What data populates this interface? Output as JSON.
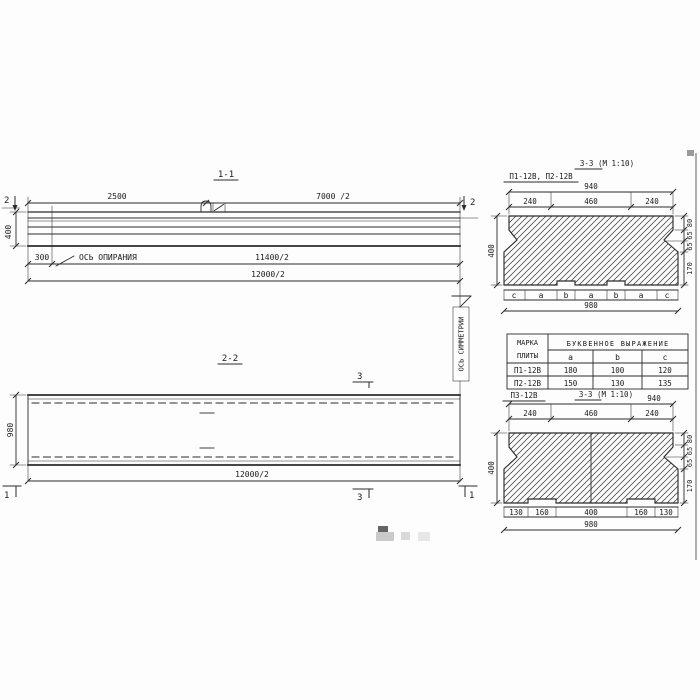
{
  "s11": {
    "title": "1-1",
    "d2500": "2500",
    "d7000": "7000 /2",
    "mark2": "2",
    "d400": "400",
    "d300": "300",
    "support_axis": "ОСЬ ОПИРАНИЯ",
    "d11400": "11400/2",
    "d12000": "12000/2"
  },
  "s22": {
    "title": "2-2",
    "mark3": "3",
    "mark1": "1",
    "d980": "980",
    "d12000": "12000/2"
  },
  "sym": {
    "label": "ОСЬ СИММЕТРИИ"
  },
  "s33t": {
    "title": "3-3 (М 1:10)",
    "marks": "П1-12В, П2-12В",
    "d940": "940",
    "top": [
      "240",
      "460",
      "240"
    ],
    "d400": "400",
    "h": [
      "80",
      "65",
      "65",
      "170"
    ],
    "letters": [
      "c",
      "a",
      "b",
      "a",
      "b",
      "a",
      "c"
    ],
    "d980": "980"
  },
  "tbl": {
    "h1a": "МАРКА",
    "h1b": "ПЛИТЫ",
    "h2": "БУКВЕННОЕ ВЫРАЖЕНИЕ",
    "sub": [
      "a",
      "b",
      "c"
    ],
    "rows": [
      {
        "mark": "П1-12В",
        "a": "180",
        "b": "100",
        "c": "120"
      },
      {
        "mark": "П2-12В",
        "a": "150",
        "b": "130",
        "c": "135"
      }
    ]
  },
  "s33b": {
    "title": "3-3 (М 1:10)",
    "mark": "П3-12В",
    "d940": "940",
    "top": [
      "240",
      "460",
      "240"
    ],
    "d400": "400",
    "h": [
      "80",
      "65",
      "65",
      "170"
    ],
    "bottom": [
      "130",
      "160",
      "400",
      "160",
      "130"
    ],
    "d980": "980"
  }
}
